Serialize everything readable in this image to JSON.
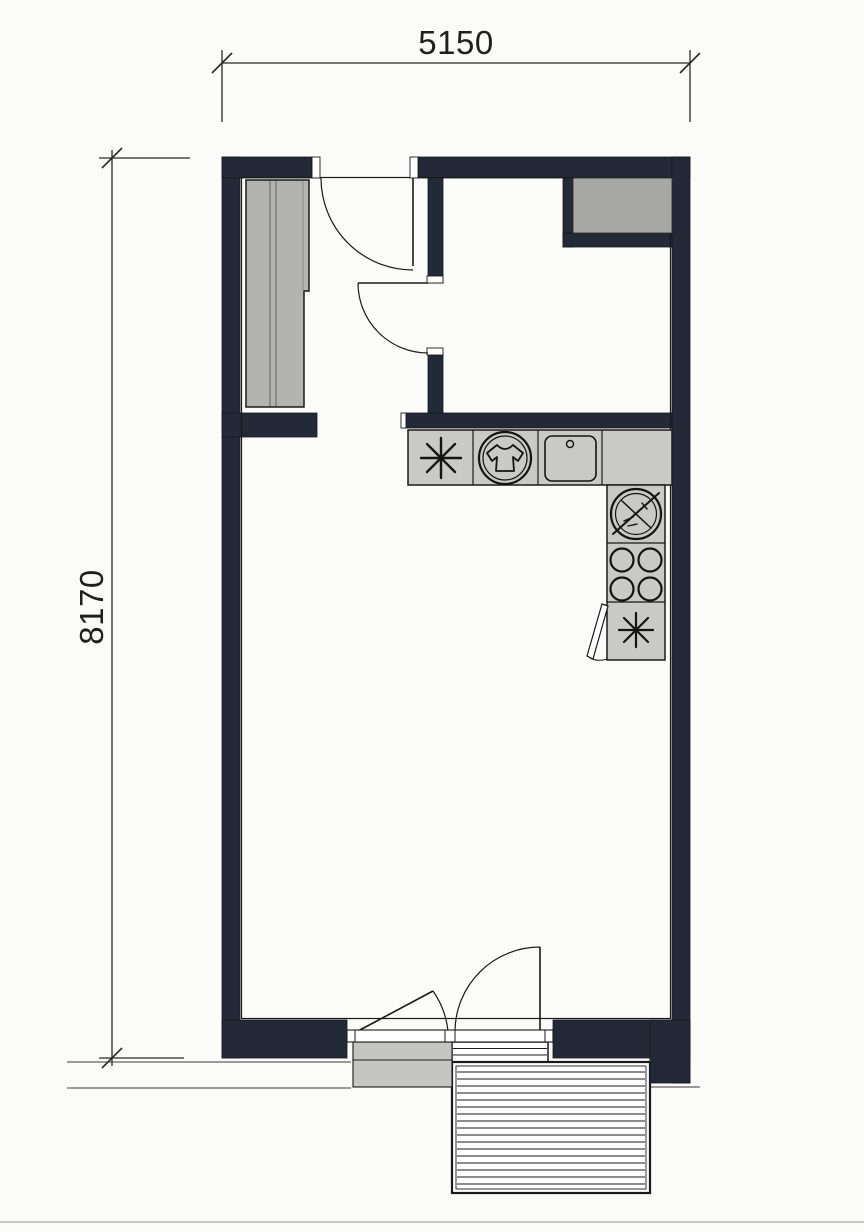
{
  "plan": {
    "dim_width_label": "5150",
    "dim_height_label": "8170"
  },
  "icons": {
    "wardrobe": "sliding-wardrobe",
    "washer": "washing-machine-icon",
    "sink": "kitchen-sink-icon",
    "hob": "four-burner-hob-icon",
    "appliance_star_top": "asterisk-appliance-icon",
    "appliance_star_bottom": "asterisk-appliance-icon",
    "crossed_circle": "crossed-circle-appliance-icon",
    "shaft": "ventilation-shaft",
    "deck": "decking-stairs"
  },
  "colors": {
    "wall": "#232936",
    "counter": "#c9c9c5",
    "wardrobe": "#b3b3af",
    "shaft": "#a7a7a3",
    "sill": "#c5c5c1",
    "line": "#1a1a1a",
    "background": "#fbfbf9"
  }
}
